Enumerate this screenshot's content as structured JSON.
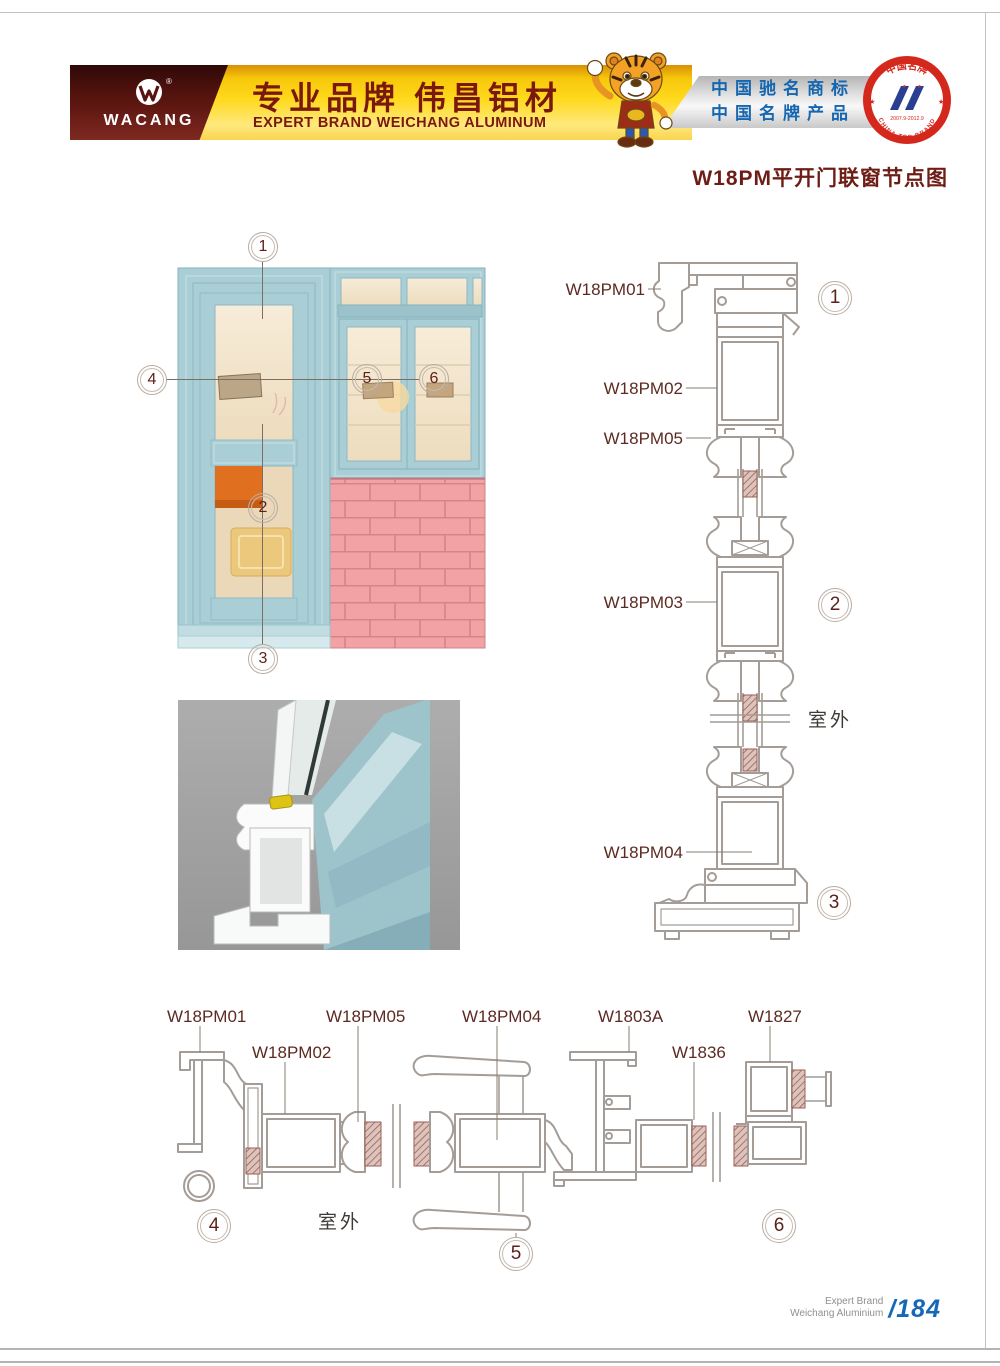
{
  "header": {
    "logo": {
      "brand": "WACANG",
      "registered": "®"
    },
    "banner": {
      "title_cn": "专业品牌  伟昌铝材",
      "subtitle_en": "EXPERT BRAND WEICHANG ALUMINUM"
    },
    "awards": {
      "line1": "中国驰名商标",
      "line2": "中国名牌产品"
    },
    "badge": {
      "arc_top": "中国名牌",
      "arc_bottom": "CHINA TOP BRAND",
      "dates": "2007.9-2012.9"
    }
  },
  "title": "W18PM平开门联窗节点图",
  "illustration": {
    "callouts": {
      "c1": "1",
      "c2": "2",
      "c3": "3",
      "c4": "4",
      "c5": "5",
      "c6": "6"
    }
  },
  "vertical_section": {
    "label_01": "W18PM01",
    "label_02": "W18PM02",
    "label_05": "W18PM05",
    "label_03": "W18PM03",
    "label_04": "W18PM04",
    "circle_1": "1",
    "circle_2": "2",
    "circle_3": "3",
    "outdoor": "室外"
  },
  "horizontal_section": {
    "label_01": "W18PM01",
    "label_02": "W18PM02",
    "label_05": "W18PM05",
    "label_04": "W18PM04",
    "label_03a": "W1803A",
    "label_36": "W1836",
    "label_27": "W1827",
    "circle_4": "4",
    "circle_5": "5",
    "circle_6": "6",
    "outdoor": "室外"
  },
  "footer": {
    "brand_line1": "Expert Brand",
    "brand_line2": "Weichang Aluminium",
    "page_number": "/184"
  },
  "colors": {
    "brand_maroon": "#5a1410",
    "banner_yellow": "#ffd91c",
    "award_blue": "#1566b0",
    "badge_red": "#d5281c",
    "title_maroon": "#6d1d15",
    "frame_teal": "#a9ced6",
    "brick_pink": "#f2a2a4",
    "drawing_line": "#a49c96",
    "label_maroon": "#5c2a22",
    "page_number_blue": "#1568b8"
  }
}
